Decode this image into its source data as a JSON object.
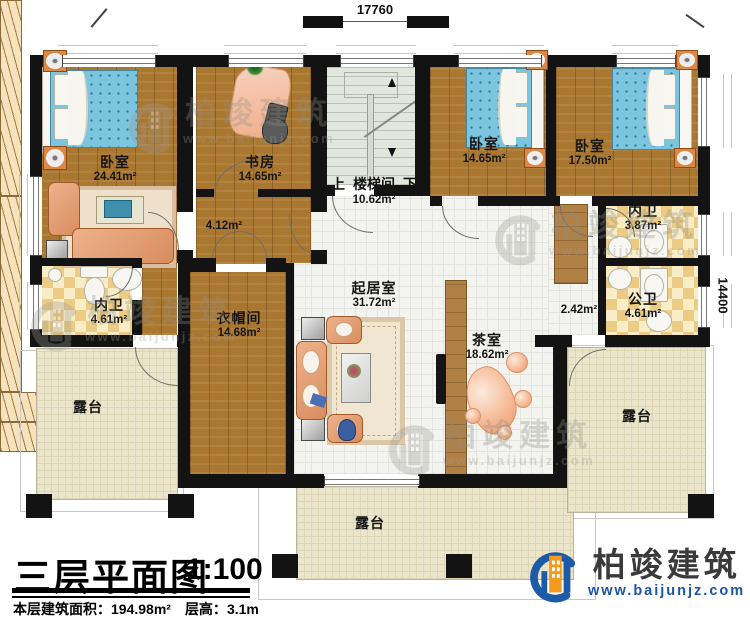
{
  "title_block": {
    "title": "三层平面图",
    "scale": "1:100",
    "area_label": "本层建筑面积：",
    "area_value": "194.98m²",
    "height_label": "层高：",
    "height_value": "3.1m"
  },
  "dimensions": {
    "top": "17760",
    "right": "14400"
  },
  "rooms": {
    "bedroom_master": {
      "name": "卧室",
      "area": "24.41m²"
    },
    "study": {
      "name": "书房",
      "area": "14.65m²"
    },
    "hallway": {
      "area": "4.12m²"
    },
    "stairwell": {
      "up": "上",
      "name": "楼梯间",
      "down": "下",
      "area": "10.62m²"
    },
    "bedroom_2": {
      "name": "卧室",
      "area": "14.65m²"
    },
    "bedroom_3": {
      "name": "卧室",
      "area": "17.50m²"
    },
    "bath_master": {
      "name": "内卫",
      "area": "4.61m²"
    },
    "bath_suite": {
      "name": "内卫",
      "area": "3.87m²"
    },
    "bath_public": {
      "name": "公卫",
      "area": "4.61m²"
    },
    "corridor": {
      "area": "2.42m²"
    },
    "living": {
      "name": "起居室",
      "area": "31.72m²"
    },
    "tea": {
      "name": "茶室",
      "area": "18.62m²"
    },
    "cloakroom": {
      "name": "衣帽间",
      "area": "14.68m²"
    },
    "terrace_left": {
      "name": "露台"
    },
    "terrace_bottom": {
      "name": "露台"
    },
    "terrace_right": {
      "name": "露台"
    }
  },
  "branding": {
    "company": "柏竣建筑",
    "website": "www.baijunjz.com"
  },
  "watermark": {
    "company": "柏竣建筑",
    "website": "www.baijunjz.com"
  },
  "colors": {
    "wall": "#131313",
    "wood_floor": "#aa7730",
    "tile_floor": "#f3f3ef",
    "terrace": "#ebe6cb",
    "bath_checker": "#eccb85",
    "bed_blue": "#7cc5df",
    "sofa_salmon": "#d98d5f",
    "brand_blue": "#1d5aa7",
    "brand_orange": "#f49a1c"
  }
}
